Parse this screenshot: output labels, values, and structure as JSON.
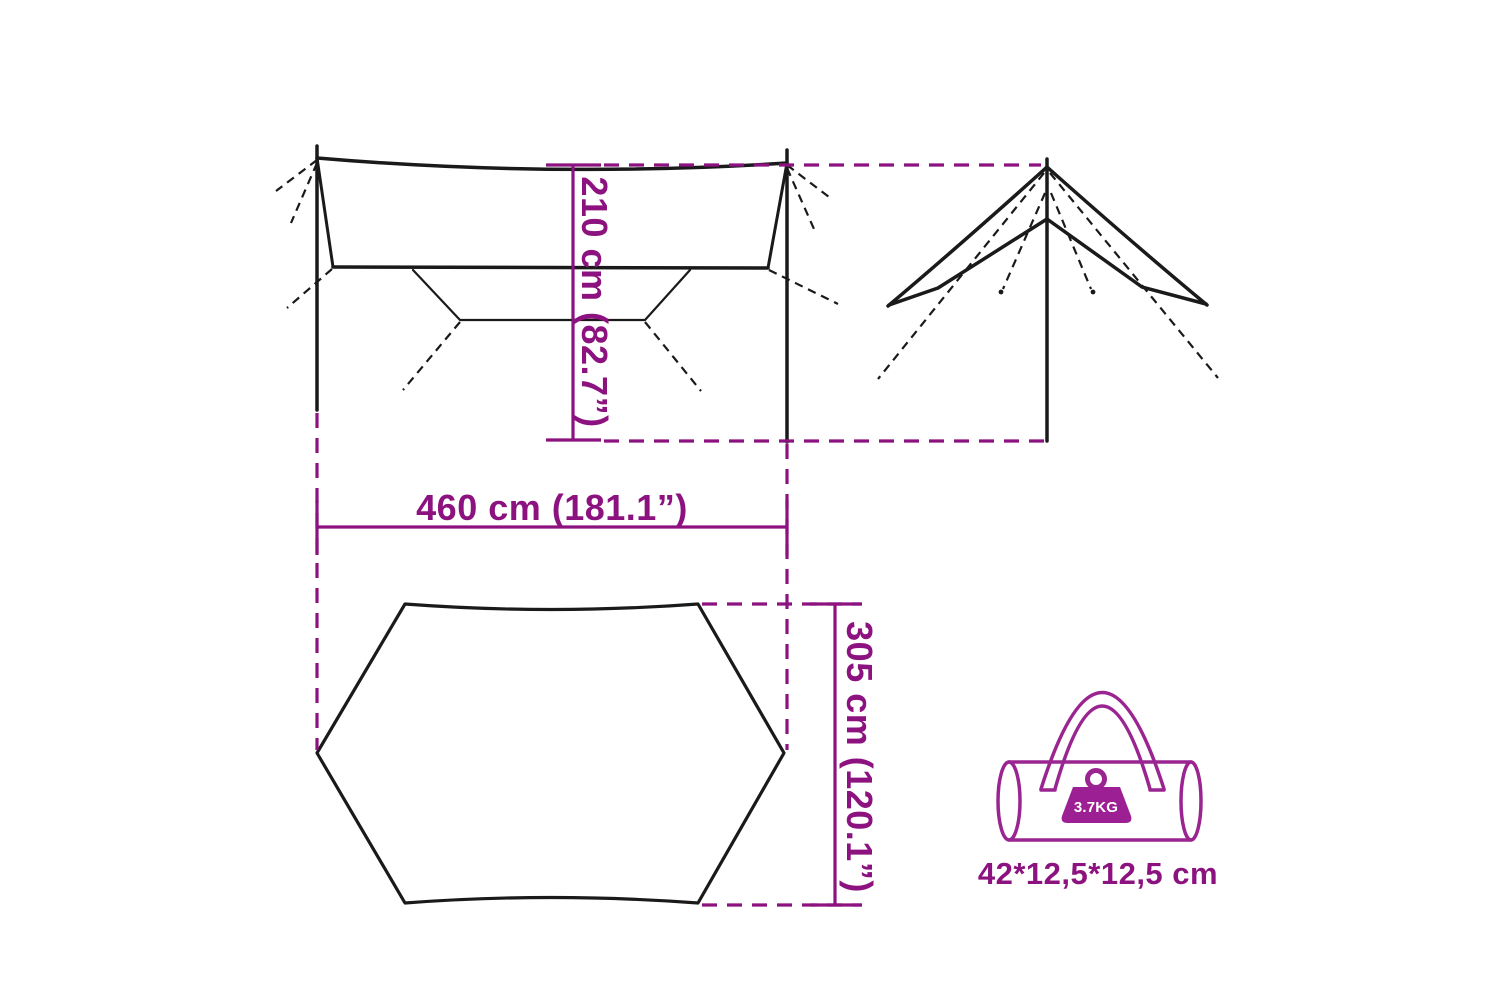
{
  "diagram": {
    "dimension_height": "210 cm (82.7”)",
    "dimension_width": "460 cm (181.1”)",
    "dimension_depth": "305 cm (120.1”)"
  },
  "bag": {
    "weight_label": "3.7KG",
    "packed_size": "42*12,5*12,5 cm"
  },
  "colors": {
    "outline": "#1a1a1a",
    "dimension": "#8c127f",
    "bag": "#9a2590",
    "weight_fill": "#9c2093",
    "weight_label_color": "#ffffff",
    "background": "#ffffff"
  },
  "icons": {
    "bag_icon": "carry-bag-icon",
    "weight_icon": "weight-icon"
  }
}
